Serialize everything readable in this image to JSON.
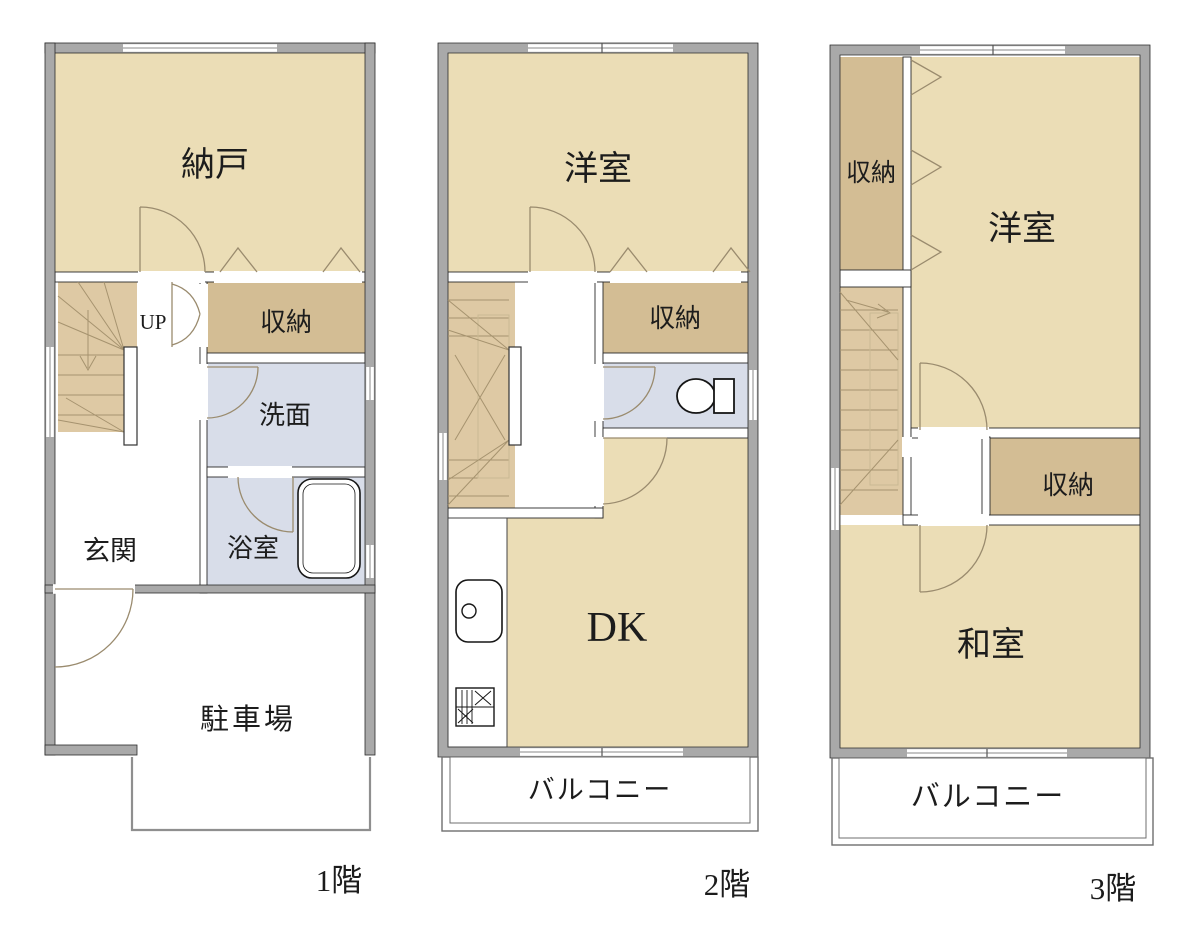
{
  "colors": {
    "room": "#EBDDB6",
    "closet": "#D3BD94",
    "stairs": "#DEC9A4",
    "wet": "#D8DDE9",
    "wall": "#A9A9A9",
    "wallline": "#2B2B2B",
    "innerwall": "#FFFFFF",
    "doorline": "#9A8B6E",
    "balconyline": "#6F6F6F",
    "text": "#1C1C1C"
  },
  "floors": [
    {
      "label": "1階",
      "rooms": {
        "storage_large": "納戸",
        "stairs_up": "UP",
        "closet": "収納",
        "washroom": "洗面",
        "bathroom": "浴室",
        "entrance": "玄関",
        "parking": "駐車場"
      }
    },
    {
      "label": "2階",
      "rooms": {
        "western_room": "洋室",
        "closet": "収納",
        "dining_kitchen": "DK",
        "balcony": "バルコニー"
      }
    },
    {
      "label": "3階",
      "rooms": {
        "closet_upper": "収納",
        "western_room": "洋室",
        "closet_mid": "収納",
        "japanese_room": "和室",
        "balcony": "バルコニー"
      }
    }
  ]
}
